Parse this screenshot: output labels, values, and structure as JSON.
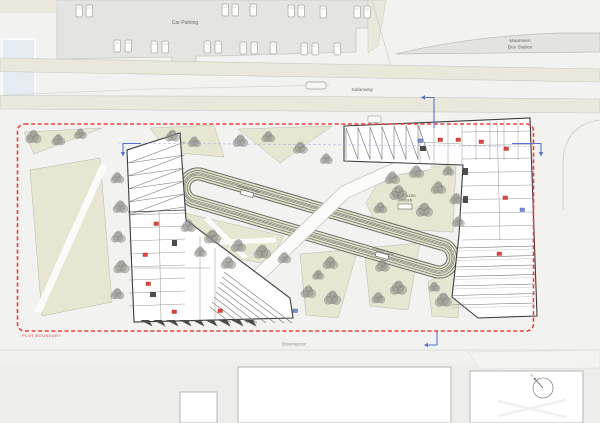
{
  "title": "Architectural Site Plan",
  "labels": {
    "car_parking": "Car Parking",
    "bus_station_1": "Maarssen",
    "bus_station_2": "Bus Station",
    "safariweg": "Safariweg",
    "bisonspoor": "Bisonspoor",
    "plot_boundary": "PLOT BOUNDARY",
    "track_upper": "RUNNING TRACK",
    "track_lower": "RUNNING TRACK",
    "courtyard_1": "COURTYARD",
    "courtyard_2": "GARDEN",
    "north": "N"
  },
  "colors": {
    "plot_boundary": "#e8413c",
    "entry_arrow": "#5b6fd4",
    "section_line": "#97a4e0",
    "green": "#e7e6d2",
    "green_edge": "#b9b8a8",
    "track_fill": "#e3e2cc",
    "track_line": "#6b6b66",
    "beige_band": "#e9e8da",
    "parking_gray": "#e4e4e2",
    "building_wall": "#3c3c3c",
    "interior_line": "#8a8a85",
    "tree": "#8f8f89",
    "tree_edge": "#6e6e68",
    "chip_red": "#e0453f",
    "chip_blue": "#7b8fd9",
    "water": "#e4ecf1",
    "label_gray": "#6a6a66"
  },
  "trees": [
    [
      33,
      137,
      1
    ],
    [
      58,
      140,
      0.85
    ],
    [
      80,
      134,
      0.8
    ],
    [
      172,
      136,
      0.9
    ],
    [
      194,
      142,
      0.8
    ],
    [
      240,
      141,
      0.95
    ],
    [
      268,
      137,
      0.85
    ],
    [
      300,
      148,
      0.9
    ],
    [
      326,
      159,
      0.8
    ],
    [
      117,
      178,
      0.85
    ],
    [
      120,
      207,
      0.95
    ],
    [
      118,
      237,
      0.9
    ],
    [
      121,
      267,
      1
    ],
    [
      117,
      294,
      0.85
    ],
    [
      188,
      226,
      0.95
    ],
    [
      212,
      237,
      1.05
    ],
    [
      238,
      246,
      0.95
    ],
    [
      262,
      252,
      1.05
    ],
    [
      284,
      258,
      0.85
    ],
    [
      200,
      252,
      0.8
    ],
    [
      228,
      263,
      0.95
    ],
    [
      392,
      178,
      0.95
    ],
    [
      416,
      172,
      0.95
    ],
    [
      398,
      193,
      1.1
    ],
    [
      438,
      188,
      0.95
    ],
    [
      380,
      208,
      0.85
    ],
    [
      424,
      210,
      1.05
    ],
    [
      456,
      199,
      0.85
    ],
    [
      448,
      171,
      0.75
    ],
    [
      458,
      222,
      0.8
    ],
    [
      330,
      263,
      0.95
    ],
    [
      308,
      292,
      0.95
    ],
    [
      332,
      298,
      1.05
    ],
    [
      318,
      275,
      0.75
    ],
    [
      382,
      266,
      0.9
    ],
    [
      398,
      288,
      1.05
    ],
    [
      378,
      298,
      0.85
    ],
    [
      443,
      300,
      1.05
    ],
    [
      434,
      287,
      0.75
    ]
  ],
  "cars": [
    [
      76,
      5
    ],
    [
      86,
      5
    ],
    [
      222,
      4
    ],
    [
      232,
      4
    ],
    [
      250,
      4
    ],
    [
      288,
      5
    ],
    [
      298,
      5
    ],
    [
      320,
      6
    ],
    [
      354,
      6
    ],
    [
      364,
      6
    ],
    [
      114,
      40
    ],
    [
      125,
      40
    ],
    [
      151,
      41
    ],
    [
      162,
      41
    ],
    [
      204,
      41
    ],
    [
      215,
      41
    ],
    [
      240,
      42
    ],
    [
      251,
      42
    ],
    [
      270,
      42
    ],
    [
      301,
      43
    ],
    [
      312,
      43
    ],
    [
      334,
      43
    ]
  ],
  "chips_red": [
    [
      143,
      253
    ],
    [
      146,
      282
    ],
    [
      172,
      310
    ],
    [
      218,
      309
    ],
    [
      154,
      222
    ],
    [
      438,
      138
    ],
    [
      456,
      138
    ],
    [
      479,
      140
    ],
    [
      504,
      147
    ],
    [
      503,
      196
    ],
    [
      497,
      252
    ]
  ],
  "chips_blue": [
    [
      418,
      139
    ],
    [
      293,
      309
    ],
    [
      520,
      208
    ]
  ]
}
